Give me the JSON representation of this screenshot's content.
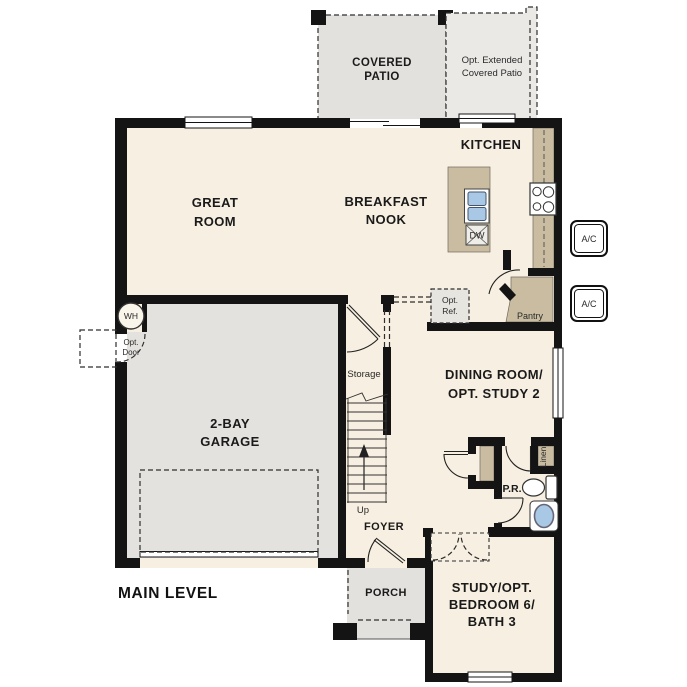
{
  "plan": {
    "level_label": "MAIN LEVEL",
    "rooms": {
      "covered_patio": {
        "lines": [
          "COVERED",
          "PATIO"
        ]
      },
      "ext_patio": {
        "lines": [
          "Opt. Extended",
          "Covered Patio"
        ]
      },
      "kitchen": {
        "label": "KITCHEN"
      },
      "great_room": {
        "lines": [
          "GREAT",
          "ROOM"
        ]
      },
      "breakfast_nook": {
        "lines": [
          "BREAKFAST",
          "NOOK"
        ]
      },
      "garage": {
        "lines": [
          "2-BAY",
          "GARAGE"
        ]
      },
      "dining": {
        "lines": [
          "DINING ROOM/",
          "OPT. STUDY 2"
        ]
      },
      "study": {
        "lines": [
          "STUDY/OPT.",
          "BEDROOM 6/",
          "BATH 3"
        ]
      },
      "foyer": {
        "label": "FOYER"
      },
      "porch": {
        "label": "PORCH"
      },
      "storage": {
        "label": "Storage"
      },
      "pantry": {
        "label": "Pantry"
      },
      "powder_room": {
        "label": "P.R."
      },
      "linen": {
        "label": "Linen"
      }
    },
    "annotations": {
      "up": "Up",
      "water_heater": "WH",
      "dishwasher": "DW",
      "ac_top": "A/C",
      "ac_bottom": "A/C",
      "opt_door": {
        "lines": [
          "Opt.",
          "Door"
        ]
      },
      "opt_ref": {
        "lines": [
          "Opt.",
          "Ref."
        ]
      }
    },
    "colors": {
      "floor": "#f7efe1",
      "garage_floor": "#e4e2df",
      "patio_floor": "#e3e1de",
      "ext_patio_floor": "#ebe9e6",
      "cabinet_tan": "#c9bca1",
      "fixture_blue": "#a9c8e6",
      "wall": "#141414"
    }
  }
}
